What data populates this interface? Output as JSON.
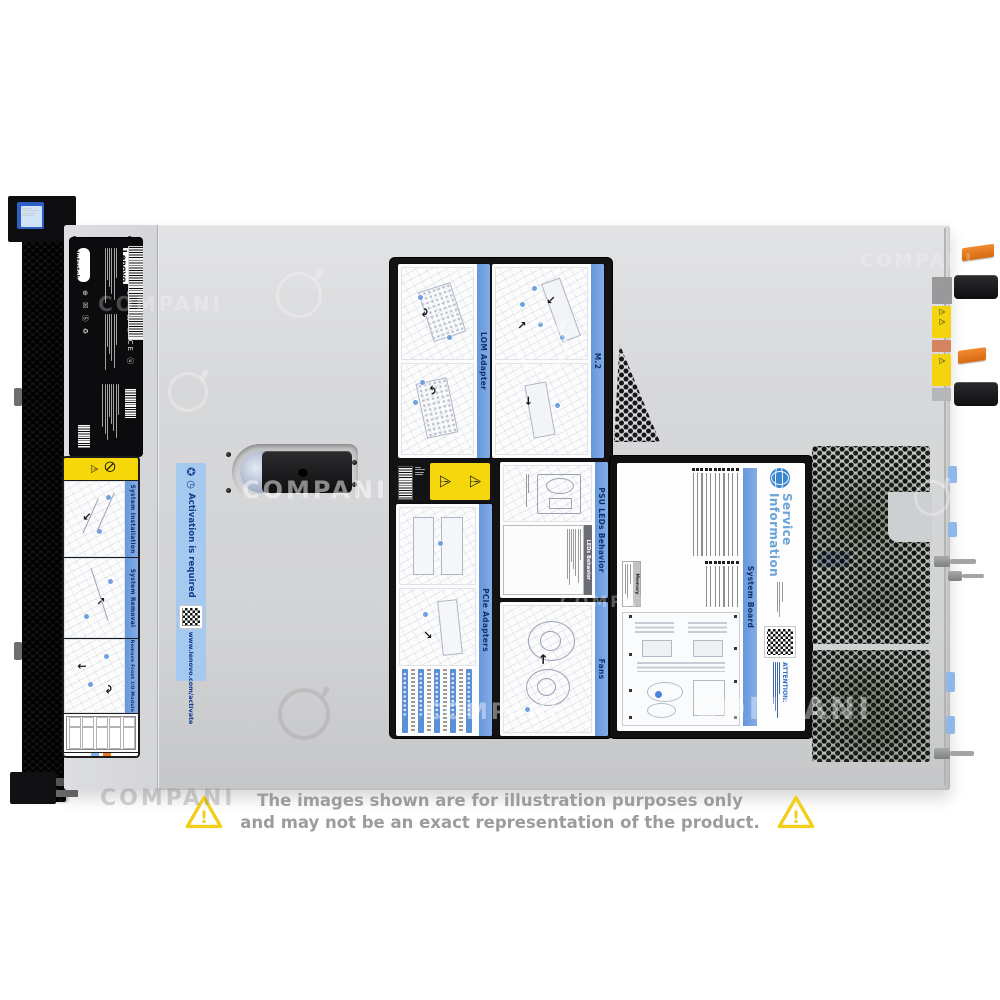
{
  "watermark": {
    "text": "COMPANI"
  },
  "brand": {
    "logo": "Lenovo",
    "cert_mark": "Intertek"
  },
  "top_labels": {
    "lom": "LOM Adapter",
    "m2": "M.2",
    "psu": "PSU LEDs Behavior",
    "psu_table": "LEDs Behavior",
    "pcie": "PCIe Adapters",
    "fans": "Fans"
  },
  "service_info": {
    "title1": "Service",
    "title2": "Information",
    "band": "System Board",
    "attention": "ATTENTION:",
    "memory": "Memory"
  },
  "front_label": {
    "sections": [
      {
        "title": "System Installation"
      },
      {
        "title": "System Removal"
      },
      {
        "title": "Remove Front I/O Module"
      }
    ]
  },
  "activation": {
    "title": "Activation is required",
    "url": "www.lenovo.com/activate"
  },
  "disclaimer": {
    "line1": "The images shown are for illustration purposes only",
    "line2": "and may not be an exact representation of the product.",
    "icon": "warning-triangle"
  },
  "colors": {
    "chassis_gray": "#d7d8da",
    "band_blue": "#6e9fe0",
    "activation_bg": "#a6c9ef",
    "activation_text": "#17418f",
    "warning_yellow": "#f4d70d",
    "psu_tab_orange": "#e8761e",
    "service_title_blue": "#68a4d8",
    "disclaimer_gray": "#9c9c9c",
    "triangle_yellow": "#f2cf1a"
  }
}
